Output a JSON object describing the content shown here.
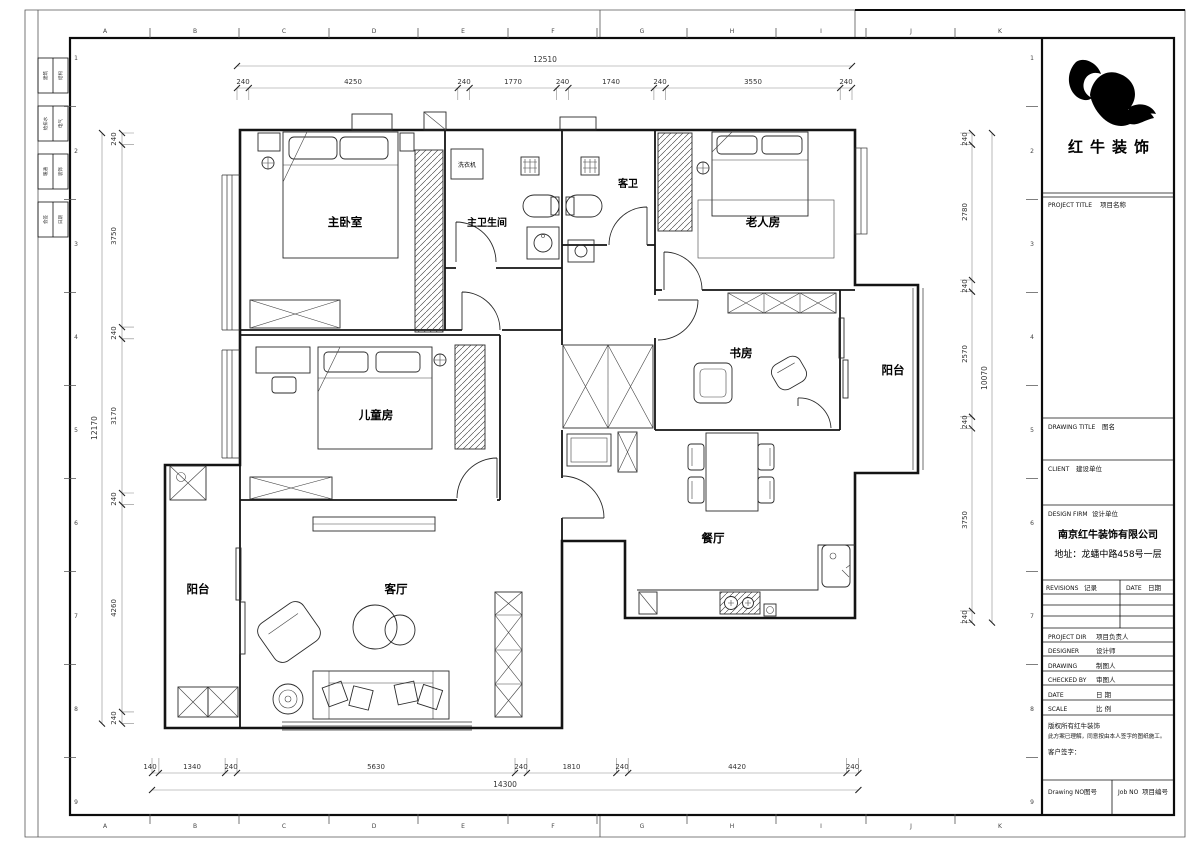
{
  "sheet": {
    "grid_letters": [
      "A",
      "B",
      "C",
      "D",
      "E",
      "F",
      "G",
      "H",
      "I",
      "J",
      "K"
    ],
    "grid_numbers": [
      "1",
      "2",
      "3",
      "4",
      "5",
      "6",
      "7",
      "8",
      "9"
    ],
    "signoff": [
      [
        "建筑",
        "结构"
      ],
      [
        "给排水",
        "电气"
      ],
      [
        "暖通",
        "装饰"
      ],
      [
        "会签",
        "日期"
      ]
    ]
  },
  "rooms": {
    "master_bedroom": "主卧室",
    "master_bathroom": "主卫生间",
    "washing_machine": "洗衣机",
    "guest_bathroom": "客卫",
    "elderly_room": "老人房",
    "study": "书房",
    "balcony_right": "阳台",
    "kids_room": "儿童房",
    "dining_room": "餐厅",
    "living_room": "客厅",
    "balcony_left": "阳台"
  },
  "dims": {
    "top": {
      "overall": "12510",
      "segments": [
        "240",
        "4250",
        "240",
        "1770",
        "240",
        "1740",
        "240",
        "3550",
        "240"
      ]
    },
    "bottom": {
      "overall": "14300",
      "segments": [
        "140",
        "1340",
        "240",
        "5630",
        "240",
        "1810",
        "240",
        "4420",
        "240"
      ]
    },
    "left": {
      "overall": "12170",
      "segments": [
        "240",
        "3750",
        "240",
        "3170",
        "240",
        "4260",
        "240"
      ]
    },
    "right": {
      "overall": "10070",
      "segments": [
        "240",
        "2780",
        "240",
        "2570",
        "240",
        "3750",
        "240"
      ]
    }
  },
  "title_block": {
    "logo_text": "红牛装饰",
    "project_title_en": "PROJECT TITLE",
    "project_title_cn": "项目名称",
    "drawing_title_en": "DRAWING TITLE",
    "drawing_title_cn": "图名",
    "client_en": "CLIENT",
    "client_cn": "建设单位",
    "design_firm_en": "DESIGN FIRM",
    "design_firm_cn": "设计单位",
    "company": "南京红牛装饰有限公司",
    "address": "地址：龙蟠中路458号一层",
    "revisions_en": "REVISIONS",
    "revisions_cn": "记录",
    "rev_date_en": "DATE",
    "rev_date_cn": "日期",
    "rows": [
      {
        "en": "PROJECT DIR",
        "cn": "项目负责人"
      },
      {
        "en": "DESIGNER",
        "cn": "设计师"
      },
      {
        "en": "DRAWING",
        "cn": "制图人"
      },
      {
        "en": "CHECKED BY",
        "cn": "审图人"
      },
      {
        "en": "DATE",
        "cn": "日  期"
      },
      {
        "en": "SCALE",
        "cn": "比  例"
      }
    ],
    "notes": [
      "版权所有红牛装饰",
      "此方案已理解，同意按由本人签字的图纸施工。",
      "客户签字："
    ],
    "drawing_no_en": "Drawing NO",
    "drawing_no_cn": "图号",
    "job_no_en": "Job NO",
    "job_no_cn": "项目编号"
  }
}
